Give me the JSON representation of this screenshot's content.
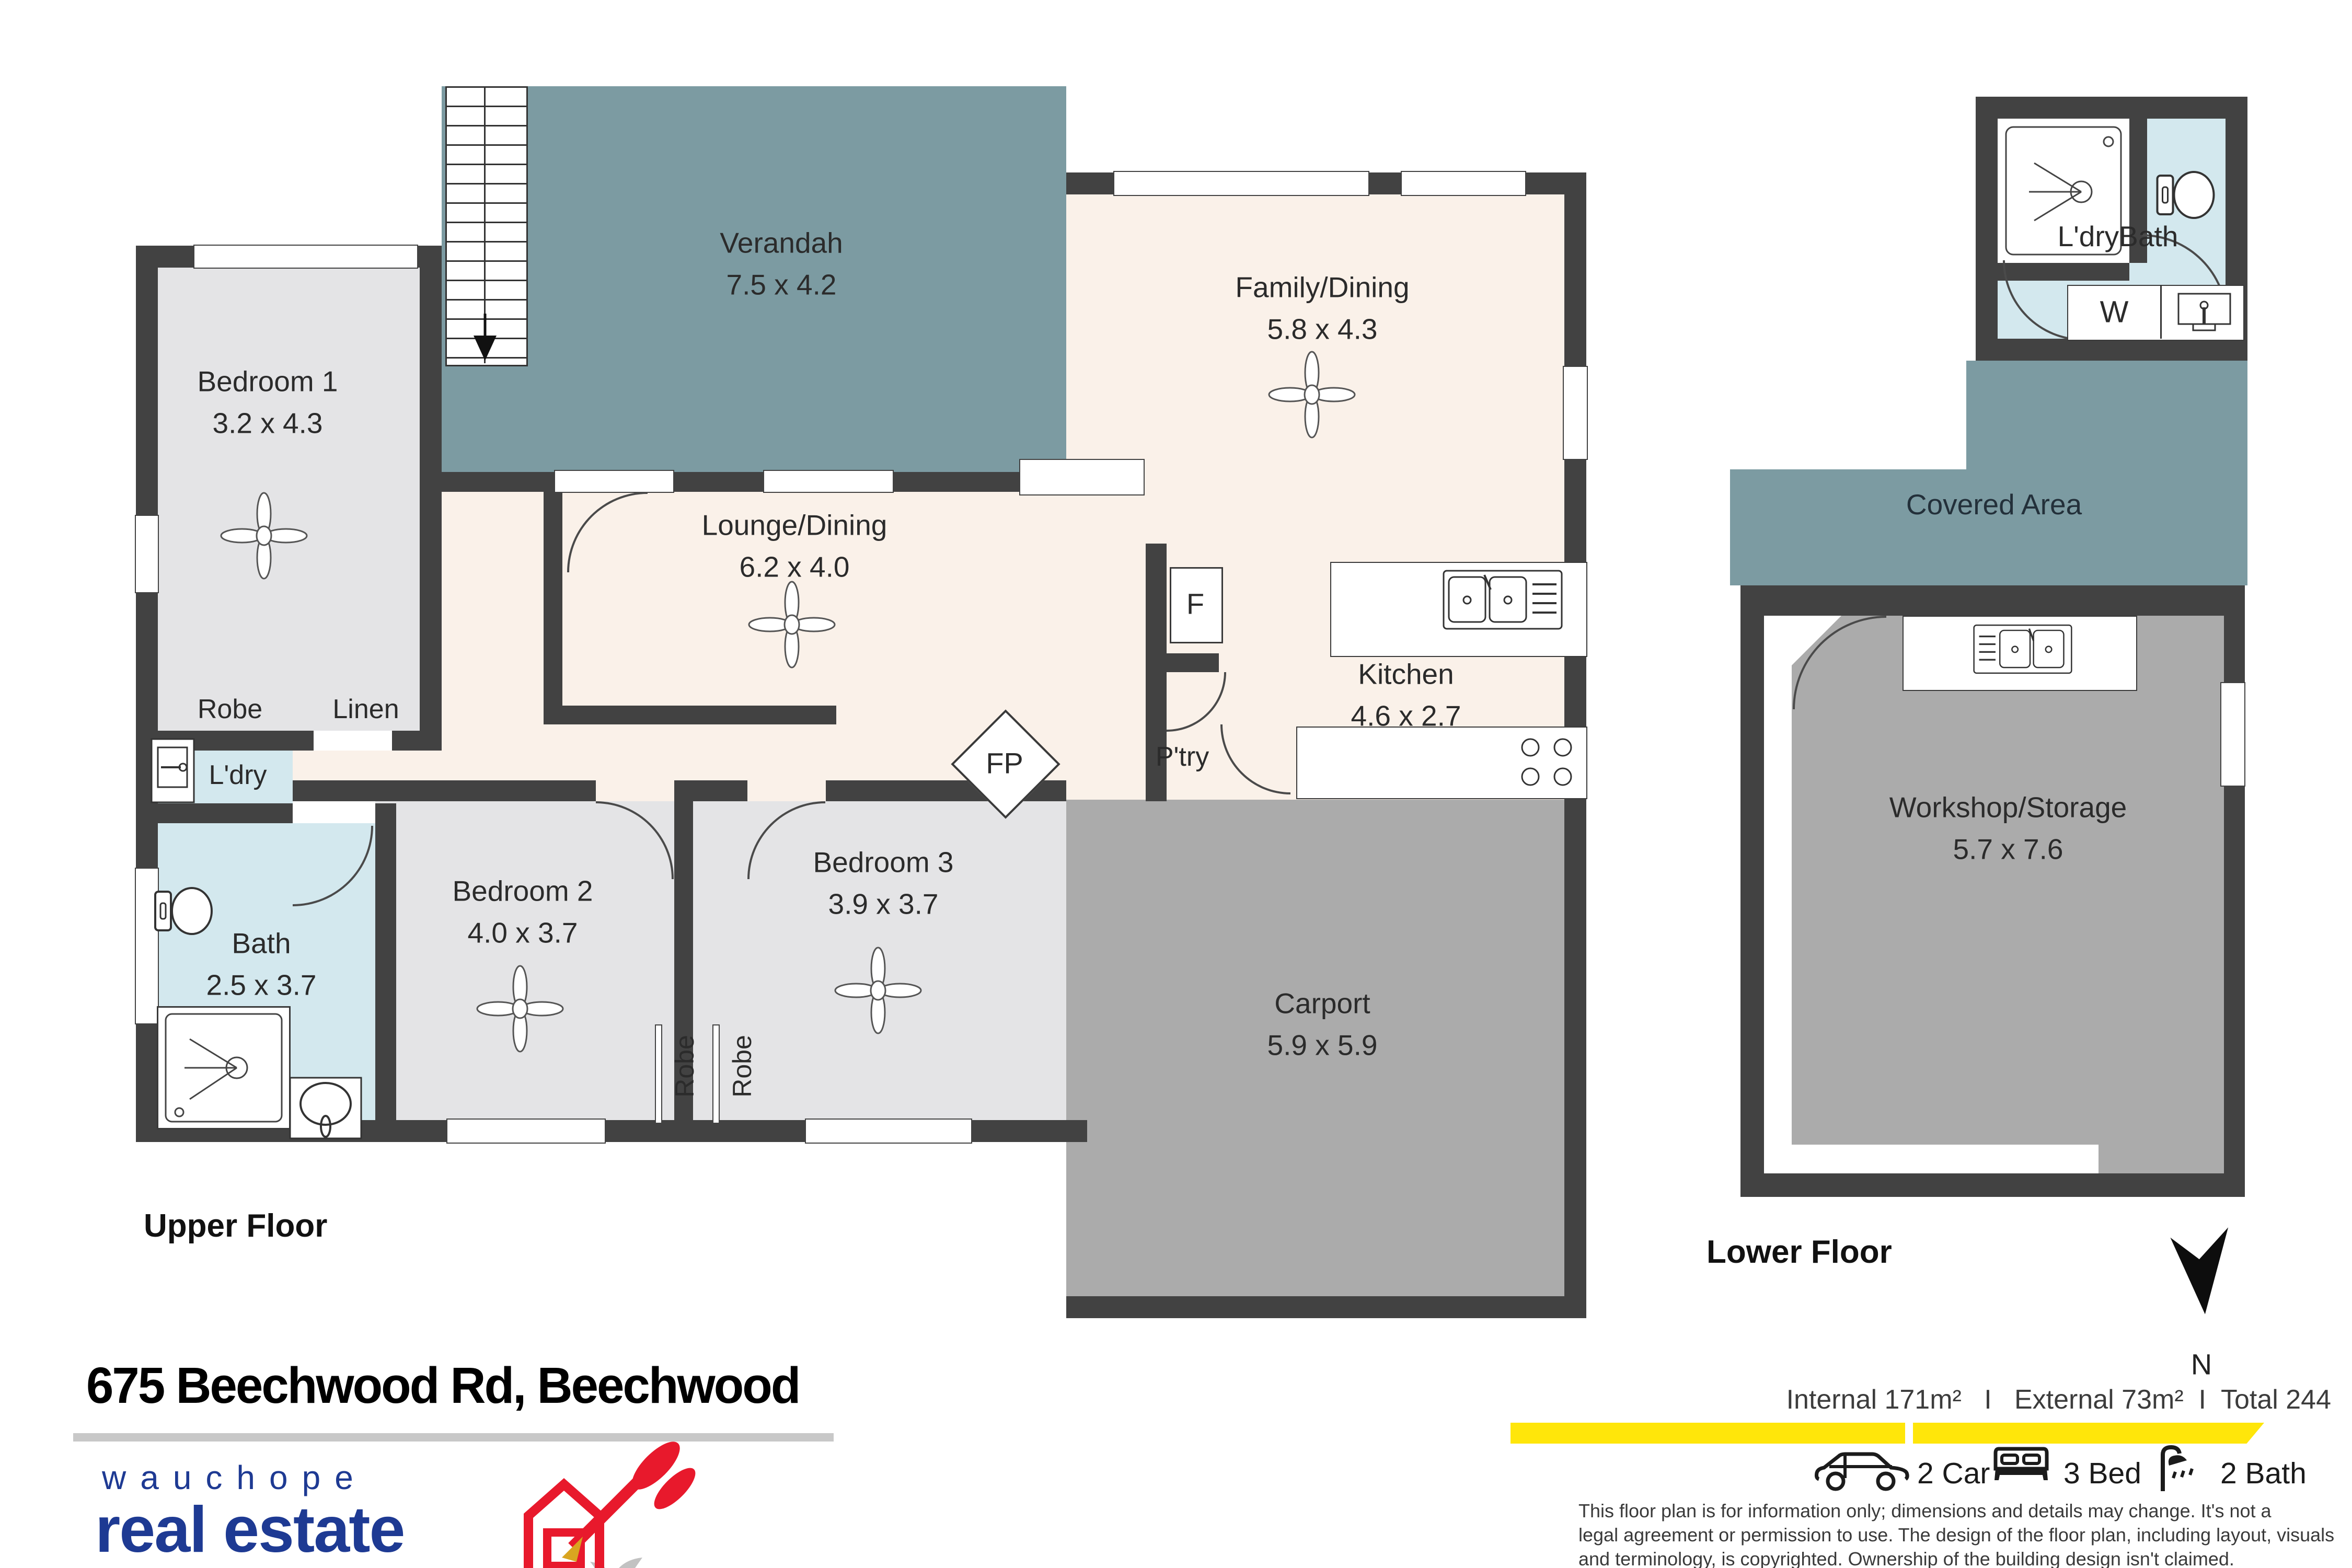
{
  "address": "675 Beechwood Rd, Beechwood",
  "floors": {
    "upper": "Upper Floor",
    "lower": "Lower Floor"
  },
  "rooms": {
    "verandah": {
      "name": "Verandah",
      "dims": "7.5 x 4.2"
    },
    "family": {
      "name": "Family/Dining",
      "dims": "5.8 x 4.3"
    },
    "lounge": {
      "name": "Lounge/Dining",
      "dims": "6.2 x 4.0"
    },
    "kitchen": {
      "name": "Kitchen",
      "dims": "4.6 x 2.7"
    },
    "bedroom1": {
      "name": "Bedroom 1",
      "dims": "3.2 x 4.3"
    },
    "bedroom2": {
      "name": "Bedroom 2",
      "dims": "4.0 x 3.7"
    },
    "bedroom3": {
      "name": "Bedroom 3",
      "dims": "3.9 x 3.7"
    },
    "bath": {
      "name": "Bath",
      "dims": "2.5 x 3.7"
    },
    "carport": {
      "name": "Carport",
      "dims": "5.9 x 5.9"
    },
    "workshop": {
      "name": "Workshop/Storage",
      "dims": "5.7 x 7.6"
    },
    "covered": {
      "name": "Covered Area"
    },
    "ldrybath": {
      "name": "L'dryBath"
    },
    "ldry": {
      "name": "L'dry"
    },
    "robe_bed1": {
      "name": "Robe"
    },
    "linen": {
      "name": "Linen"
    },
    "robe_a": {
      "name": "Robe"
    },
    "robe_b": {
      "name": "Robe"
    },
    "fridge": {
      "name": "F"
    },
    "pantry": {
      "name": "P'try"
    },
    "fireplace": {
      "name": "FP"
    },
    "washer": {
      "name": "W"
    }
  },
  "compass": {
    "label": "N"
  },
  "stats_line": "Internal 171m²   I   External 73m²  I  Total 244",
  "features": [
    {
      "icon": "car-icon",
      "label": "2 Car"
    },
    {
      "icon": "bed-icon",
      "label": "3 Bed"
    },
    {
      "icon": "shower-icon",
      "label": "2 Bath"
    }
  ],
  "brand": {
    "line1": "wauchope",
    "line2": "real estate"
  },
  "disclaimer": [
    "This floor plan is for information only; dimensions and details may change. It's not a",
    "legal agreement or permission to use. The design of the floor plan, including layout, visuals",
    "and terminology, is copyrighted. Ownership of the building design isn't claimed."
  ],
  "colors": {
    "wall": "#424242",
    "verandah_teal": "#7c9ba2",
    "bedroom_gray": "#e4e4e6",
    "wet_blue": "#d3e8ee",
    "living_cream": "#faf1e9",
    "garage_gray": "#ababab",
    "stripe_yellow": "#ffe60a",
    "brand_navy": "#1e3a93",
    "logo_red": "#e8192c"
  }
}
